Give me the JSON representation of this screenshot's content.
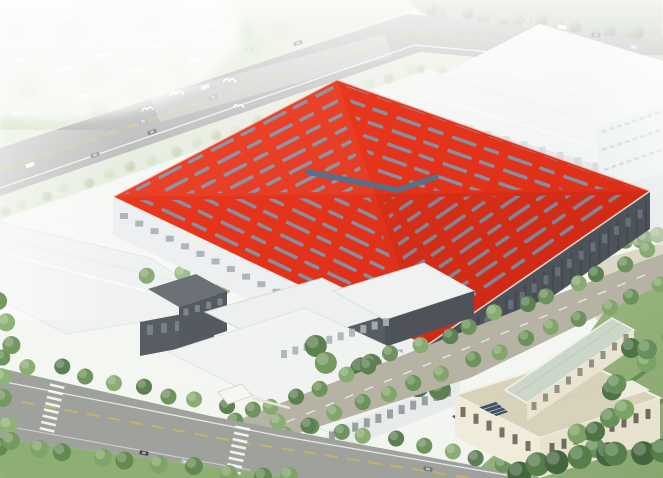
{
  "meta": {
    "description": "Aerial bird's-eye architectural rendering of an industrial campus: a huge factory hall with a vivid red roof and herringbone skylight strips, surrounded by white production halls, office buildings, tree-lined roads, lawns and flying birds in a hazy top-left corner",
    "type": "architectural-rendering",
    "width": 663,
    "height": 478
  },
  "colors": {
    "roof_red": "#e83019",
    "roof_red_light": "#ee3b1f",
    "roof_red_dark": "#d62915",
    "skylight": "#8096ab",
    "skylight_dark": "#55708a",
    "road": "#a5a7a4",
    "road_bottom": "#9fa19d",
    "campus_road": "#b7b3a4",
    "road_line_yellow": "#c9b264",
    "road_line_white": "#f7f8f6",
    "white_building": "#eff2f1",
    "white_wall": "#dce2e3",
    "wall_dark": "#4d5359",
    "wall_dark2": "#575d62",
    "window_band": "#a2abb2",
    "beige_roof": "#d9d2ba",
    "beige_wall": "#e9e2cf",
    "green_roof": "#ccd6c9",
    "solar_panel": "#3f5064",
    "lawn": "#94b07a",
    "tree_green": "#6e925c",
    "tree_dark": "#4f7347",
    "tree_light": "#9cbd85",
    "hazy_forest": "#c3d4ae",
    "verge": "#dfe5d4",
    "pavement": "#d7d2bf",
    "bird_white": "#ffffff",
    "haze": "#ffffff"
  },
  "scene": {
    "roof": {
      "corners": {
        "L": [
          113,
          197
        ],
        "T": [
          337,
          80
        ],
        "R": [
          650,
          191
        ],
        "B": [
          426,
          346
        ],
        "C": [
          375,
          194
        ]
      },
      "wall_height": 38,
      "stripe": {
        "tile_w": 59,
        "tile_h": 14,
        "dash": "24 11 13 11",
        "width": 3.5,
        "inset": 0.93,
        "rotations": {
          "nw": -27.4,
          "ne": 19.4,
          "se": -34.5,
          "sw": 25.5
        }
      },
      "ridge_bars": [
        [
          308,
          172,
          398,
          190
        ],
        [
          398,
          190,
          436,
          177
        ]
      ]
    },
    "forest_blobs": [
      [
        15,
        25,
        14
      ],
      [
        40,
        60,
        12
      ],
      [
        70,
        30,
        13
      ],
      [
        95,
        75,
        11
      ],
      [
        120,
        45,
        12
      ],
      [
        150,
        20,
        10
      ],
      [
        175,
        60,
        12
      ],
      [
        205,
        35,
        11
      ],
      [
        230,
        15,
        10
      ],
      [
        255,
        45,
        10
      ],
      [
        60,
        105,
        11
      ],
      [
        100,
        110,
        10
      ],
      [
        140,
        90,
        11
      ],
      [
        20,
        135,
        10
      ],
      [
        60,
        140,
        9
      ],
      [
        185,
        85,
        9
      ],
      [
        215,
        65,
        9
      ],
      [
        245,
        30,
        8
      ],
      [
        280,
        28,
        9
      ],
      [
        310,
        12,
        8
      ],
      [
        90,
        10,
        12
      ],
      [
        130,
        8,
        10
      ],
      [
        170,
        5,
        9
      ],
      [
        28,
        88,
        12
      ]
    ],
    "tree_bands": [
      {
        "layer": "treeline-topright",
        "from": [
          428,
          14
        ],
        "to": [
          660,
          38
        ],
        "count": 14,
        "r": 6,
        "spread": 7,
        "palette": [
          "#6f8263",
          "#86977a"
        ],
        "opacity": 0.85
      },
      {
        "layer": "verge-trees",
        "from": [
          2,
          212
        ],
        "to": [
          412,
          70
        ],
        "count": 20,
        "r": 5,
        "spread": 4,
        "palette": [
          "#b7cba2",
          "#cadbb8"
        ],
        "opacity": 0.9
      },
      {
        "layer": "verge-trees",
        "from": [
          420,
          68
        ],
        "to": [
          658,
          96
        ],
        "count": 12,
        "r": 4.5,
        "spread": 4,
        "palette": [
          "#b7cba2",
          "#c4d6b1"
        ],
        "opacity": 0.85
      },
      {
        "layer": "dock-trees",
        "from": [
          400,
          134
        ],
        "to": [
          626,
          196
        ],
        "count": 11,
        "r": 4.5,
        "spread": 3,
        "palette": [
          "#9cb886",
          "#85a873"
        ],
        "opacity": 0.95
      },
      {
        "layer": "right-cluster-trees",
        "from": [
          598,
          250
        ],
        "to": [
          661,
          234
        ],
        "count": 6,
        "r": 8,
        "spread": 5,
        "palette": [
          "#6f9159",
          "#87a76e"
        ],
        "opacity": 1
      },
      {
        "layer": "gap-trees",
        "from": [
          152,
          272
        ],
        "to": [
          330,
          300
        ],
        "count": 8,
        "r": 8,
        "spread": 9,
        "palette": [
          "#86a871",
          "#9cbd85"
        ],
        "opacity": 0.95
      },
      {
        "layer": "courtyard-trees",
        "from": [
          320,
          348
        ],
        "to": [
          432,
          396
        ],
        "count": 7,
        "r": 11,
        "spread": 13,
        "palette": [
          "#5d8050",
          "#76995f",
          "#4f7347"
        ],
        "opacity": 1
      },
      {
        "layer": "r3-trees",
        "from": [
          240,
          418
        ],
        "to": [
          652,
          252
        ],
        "count": 17,
        "r": 8,
        "spread": 5,
        "palette": [
          "#6e925c",
          "#86aa6f",
          "#5d8052"
        ],
        "opacity": 1
      },
      {
        "layer": "r3-trees",
        "from": [
          256,
          448
        ],
        "to": [
          660,
          286
        ],
        "count": 16,
        "r": 8,
        "spread": 5,
        "palette": [
          "#6e925c",
          "#83a56c"
        ],
        "opacity": 1
      },
      {
        "layer": "r2-trees",
        "from": [
          5,
          358
        ],
        "to": [
          505,
          466
        ],
        "count": 19,
        "r": 8,
        "spread": 6,
        "palette": [
          "#6f935d",
          "#89ad72",
          "#5d8052"
        ],
        "opacity": 1
      },
      {
        "layer": "r2-trees",
        "from": [
          2,
          446
        ],
        "to": [
          290,
          478
        ],
        "count": 10,
        "r": 9,
        "spread": 6,
        "palette": [
          "#648a52",
          "#7fa368"
        ],
        "opacity": 1
      },
      {
        "layer": "r2-trees",
        "from": [
          4,
          300
        ],
        "to": [
          4,
          470
        ],
        "count": 8,
        "r": 9,
        "spread": 10,
        "palette": [
          "#76995f",
          "#8fb277"
        ],
        "opacity": 1
      },
      {
        "layer": "lawn-trees",
        "from": [
          575,
          460
        ],
        "to": [
          656,
          332
        ],
        "count": 12,
        "r": 10,
        "spread": 15,
        "palette": [
          "#4f7347",
          "#68905a",
          "#7ca366"
        ],
        "opacity": 1
      },
      {
        "layer": "lawn-trees",
        "from": [
          520,
          470
        ],
        "to": [
          660,
          446
        ],
        "count": 8,
        "r": 12,
        "spread": 9,
        "palette": [
          "#44663e",
          "#567d4a"
        ],
        "opacity": 1
      }
    ],
    "rows": [
      {
        "layer": "dock-doors",
        "from": [
          398,
          112
        ],
        "to": [
          596,
          170
        ],
        "count": 12,
        "w": 7,
        "h": 15,
        "fill": "#c6cfd5",
        "opacity": 0.92
      },
      {
        "layer": "red-wall-rows",
        "from": [
          124,
          216
        ],
        "to": [
          414,
          360
        ],
        "count": 20,
        "w": 8,
        "h": 6,
        "fill": "#a2abb2",
        "opacity": 0.85
      },
      {
        "layer": "red-wall-rows",
        "from": [
          432,
          364
        ],
        "to": [
          646,
          216
        ],
        "count": 24,
        "w": 2,
        "h": 30,
        "fill": "#3e444a",
        "opacity": 0.55
      },
      {
        "layer": "red-wall-rows",
        "from": [
          440,
          354
        ],
        "to": [
          640,
          214
        ],
        "count": 18,
        "w": 5,
        "h": 9,
        "fill": "#6b7680",
        "opacity": 0.85
      },
      {
        "layer": "office-rows",
        "from": [
          332,
          436
        ],
        "to": [
          448,
          392
        ],
        "count": 11,
        "w": 6,
        "h": 9,
        "fill": "#8f979d",
        "opacity": 0.9
      },
      {
        "layer": "office-rows",
        "from": [
          284,
          354
        ],
        "to": [
          386,
          322
        ],
        "count": 10,
        "w": 6,
        "h": 8,
        "fill": "#aab3b9",
        "opacity": 0.9
      },
      {
        "layer": "office-rows",
        "from": [
          186,
          312
        ],
        "to": [
          220,
          302
        ],
        "count": 4,
        "w": 5,
        "h": 7,
        "fill": "#7d858c",
        "opacity": 1
      },
      {
        "layer": "left-bldg-rows",
        "from": [
          150,
          330
        ],
        "to": [
          206,
          322
        ],
        "count": 5,
        "w": 6,
        "h": 10,
        "fill": "#7b838a",
        "opacity": 0.95
      },
      {
        "layer": "beige-rows",
        "from": [
          552,
          448
        ],
        "to": [
          648,
          414
        ],
        "count": 9,
        "w": 5,
        "h": 10,
        "fill": "#6e6a5c",
        "opacity": 1
      },
      {
        "layer": "beige-rows",
        "from": [
          463,
          412
        ],
        "to": [
          528,
          446
        ],
        "count": 6,
        "w": 5,
        "h": 10,
        "fill": "#77735f",
        "opacity": 1
      },
      {
        "layer": "green-bldg-rows",
        "from": [
          534,
          406
        ],
        "to": [
          626,
          338
        ],
        "count": 9,
        "w": 5,
        "h": 8,
        "fill": "#8b8774",
        "opacity": 0.9
      }
    ],
    "cars_top_road": [
      [
        30,
        165,
        -19,
        "#f2f3f2"
      ],
      [
        95,
        155,
        -19,
        "#6b7075"
      ],
      [
        108,
        166,
        -19,
        "#f4f4f3"
      ],
      [
        143,
        121,
        -19,
        "#9aa0a4"
      ],
      [
        152,
        132,
        -19,
        "#50555b"
      ],
      [
        205,
        87,
        -19,
        "#eceded"
      ],
      [
        213,
        97,
        -19,
        "#7c8288"
      ],
      [
        249,
        50,
        -19,
        "#b9bec2"
      ],
      [
        298,
        43,
        -17,
        "#62686e"
      ],
      [
        360,
        22,
        -14,
        "#d7d9d9"
      ],
      [
        528,
        21,
        6,
        "#8f959a"
      ],
      [
        562,
        27,
        7,
        "#f1f2f1"
      ],
      [
        596,
        35,
        8,
        "#565c62"
      ],
      [
        634,
        47,
        9,
        "#c4c8cb"
      ]
    ],
    "cars_bottom_road": [
      [
        144,
        453,
        11,
        "#3f4448"
      ],
      [
        186,
        462,
        11,
        "#c0c4c6"
      ],
      [
        428,
        469,
        12,
        "#70767b"
      ]
    ],
    "crosswalks": [
      {
        "cx": 52,
        "cy": 408,
        "angle": 13,
        "bars": 8,
        "bar_len": 15,
        "bar_w": 2.6,
        "gap": 6.4
      },
      {
        "cx": 238,
        "cy": 450,
        "angle": 12,
        "bars": 8,
        "bar_len": 15,
        "bar_w": 2.6,
        "gap": 6.4
      }
    ],
    "birds": [
      [
        16,
        60,
        1.1,
        -8
      ],
      [
        34,
        36,
        0.9,
        5
      ],
      [
        58,
        68,
        1.2,
        -4
      ],
      [
        78,
        94,
        1.0,
        8
      ],
      [
        96,
        54,
        1.3,
        -6
      ],
      [
        114,
        28,
        0.8,
        4
      ],
      [
        130,
        70,
        1.1,
        -10
      ],
      [
        152,
        46,
        1.0,
        6
      ],
      [
        170,
        92,
        1.2,
        -5
      ],
      [
        190,
        58,
        0.9,
        8
      ],
      [
        206,
        26,
        0.8,
        -4
      ],
      [
        224,
        78,
        1.1,
        5
      ],
      [
        64,
        16,
        0.8,
        6
      ],
      [
        142,
        108,
        1.0,
        -7
      ],
      [
        234,
        104,
        0.9,
        6
      ],
      [
        12,
        112,
        1.0,
        5
      ]
    ],
    "people": [
      [
        256,
        436
      ],
      [
        263,
        441
      ],
      [
        492,
        420
      ]
    ]
  }
}
